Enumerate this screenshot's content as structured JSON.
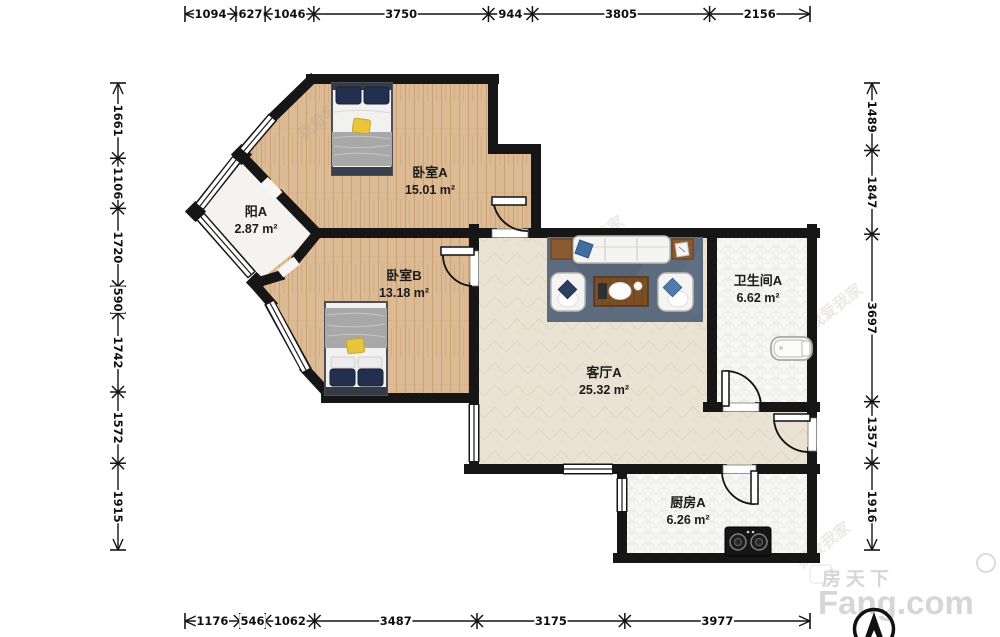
{
  "brand": {
    "cn": "房天下",
    "en": "Fang.com"
  },
  "watermark": {
    "text": "我爱我家",
    "instances": [
      {
        "x": 303,
        "y": 141,
        "r": -38
      },
      {
        "x": 575,
        "y": 263,
        "r": -38
      },
      {
        "x": 813,
        "y": 331,
        "r": -38
      },
      {
        "x": 801,
        "y": 569,
        "r": -38
      }
    ]
  },
  "rooms": [
    {
      "id": "bedroom-a",
      "name": "卧室A",
      "area": "15.01 m²",
      "label_x": 430,
      "label_y": 177
    },
    {
      "id": "balcony-a",
      "name": "阳A",
      "area": "2.87 m²",
      "label_x": 256,
      "label_y": 216
    },
    {
      "id": "bedroom-b",
      "name": "卧室B",
      "area": "13.18 m²",
      "label_x": 404,
      "label_y": 280
    },
    {
      "id": "living-a",
      "name": "客厅A",
      "area": "25.32 m²",
      "label_x": 604,
      "label_y": 377
    },
    {
      "id": "bathroom-a",
      "name": "卫生间A",
      "area": "6.62 m²",
      "label_x": 758,
      "label_y": 285
    },
    {
      "id": "kitchen-a",
      "name": "厨房A",
      "area": "6.26 m²",
      "label_x": 688,
      "label_y": 507
    }
  ],
  "dimensions": {
    "top": {
      "axis": "h",
      "line": 14,
      "from": 185,
      "to": 810,
      "segments": [
        1094,
        627,
        1046,
        3750,
        944,
        3805,
        2156
      ]
    },
    "bottom": {
      "axis": "h",
      "line": 621,
      "from": 185,
      "to": 810,
      "segments": [
        1176,
        546,
        1062,
        3487,
        3175,
        3977
      ]
    },
    "left": {
      "axis": "v",
      "line": 118,
      "from": 83,
      "to": 550,
      "segments": [
        1661,
        1106,
        1720,
        590,
        1742,
        1572,
        1915
      ]
    },
    "right": {
      "axis": "v",
      "line": 872,
      "from": 83,
      "to": 550,
      "segments": [
        1489,
        1847,
        3697,
        1357,
        1916
      ]
    }
  },
  "colors": {
    "wall": "#161616",
    "wood_floor": "#dcba94",
    "living_floor": "#eae3d3",
    "tile_floor": "#f7f7f5",
    "balcony_floor": "#f4f3ef",
    "rug": "#5d6b7e",
    "navy_pillow": "#232f4e",
    "yellow_cushion": "#e9c53b",
    "wood_furniture": "#7c4e26",
    "brand_gray": "#d6d6d6"
  }
}
